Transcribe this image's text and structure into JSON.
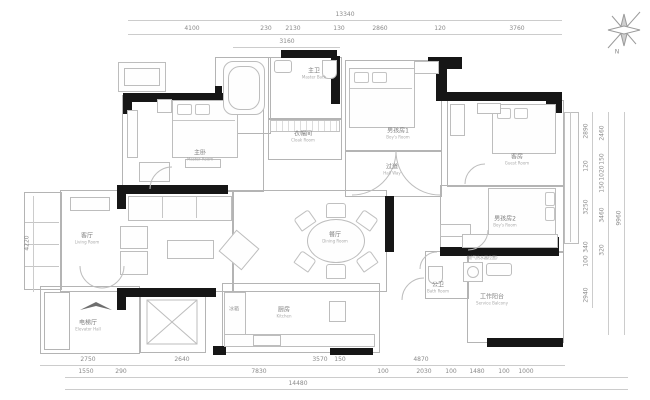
{
  "compass": {
    "north": "N"
  },
  "dims": {
    "top_total": "13340",
    "top_row": [
      "4100",
      "230",
      "2130",
      "130",
      "2860",
      "120",
      "3760"
    ],
    "top_sub": "3160",
    "bot_row1": [
      "2750",
      "2640",
      "3570",
      "150",
      "4870"
    ],
    "bot_row2": [
      "1550",
      "290",
      "7830",
      "100",
      "2030",
      "100",
      "1480",
      "100",
      "1000"
    ],
    "bot_total": "14480",
    "left": "4220",
    "right_col1": [
      "2890",
      "120",
      "3250",
      "340",
      "100",
      "2940"
    ],
    "right_col2": [
      "2460",
      "150",
      "1020",
      "150",
      "3460",
      "320"
    ],
    "right_total": "9960"
  },
  "rooms": {
    "master": {
      "zh": "主卧",
      "en": "Master Room"
    },
    "master_bath": {
      "zh": "主卫",
      "en": "Master Bath"
    },
    "cloak": {
      "zh": "衣帽间",
      "en": "Cloak Room"
    },
    "boy1": {
      "zh": "男孩房1",
      "en": "Boy's Room"
    },
    "hallway": {
      "zh": "过道",
      "en": "Hall Way"
    },
    "guest": {
      "zh": "客房",
      "en": "Guest Room"
    },
    "boy2": {
      "zh": "男孩房2",
      "en": "Boy's Room"
    },
    "bath": {
      "zh": "公卫",
      "en": "Bath Room"
    },
    "service": {
      "zh": "工作阳台",
      "en": "Service Balcony"
    },
    "kitchen": {
      "zh": "厨房",
      "en": "Kitchen"
    },
    "dining": {
      "zh": "餐厅",
      "en": "Dining Room"
    },
    "living": {
      "zh": "客厅",
      "en": "Living Room"
    },
    "elevator": {
      "zh": "电梯厅",
      "en": "Elevator Hall"
    }
  },
  "annotations": {
    "heater": "(燃气热水器位置)",
    "fridge": "冰箱"
  },
  "colors": {
    "wall": "#161616",
    "line": "#b4b4b4",
    "text": "#8a8a8a"
  }
}
